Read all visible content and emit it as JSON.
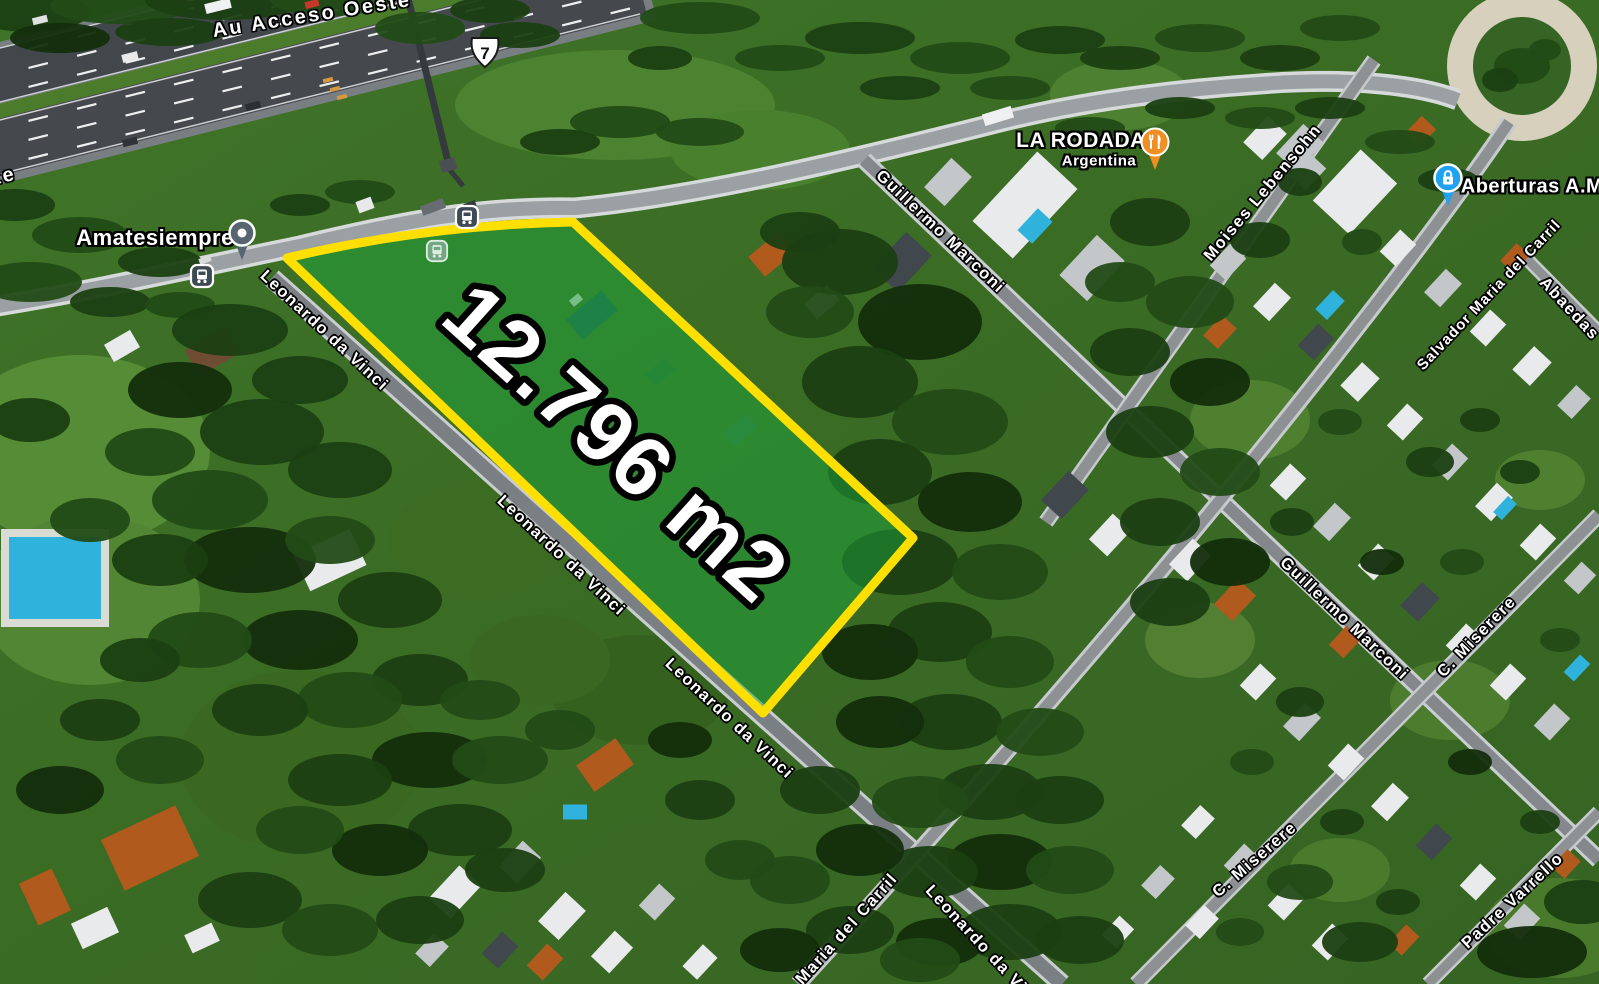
{
  "map_type": "satellite",
  "parcel": {
    "area_label": "12.796 m2",
    "outline_color": "#ffdf00",
    "fill_color": "rgba(30,165,60,0.5)"
  },
  "route_shield": {
    "number": "7"
  },
  "street_labels": [
    {
      "label": "Au Acceso Oeste"
    },
    {
      "label": "Au Acceso Oeste"
    },
    {
      "label": "Leonardo da Vinci"
    },
    {
      "label": "Leonardo da Vinci"
    },
    {
      "label": "Leonardo da Vinci"
    },
    {
      "label": "Leonardo da Vinci"
    },
    {
      "label": "Guillermo Marconi"
    },
    {
      "label": "Guillermo Marconi"
    },
    {
      "label": "Moises Lebensohn"
    },
    {
      "label": "Salvador Maria del Carril"
    },
    {
      "label": "Maria del Carril"
    },
    {
      "label": "C. Miserere"
    },
    {
      "label": "C. Miserere"
    },
    {
      "label": "Padre Varrello"
    },
    {
      "label": "Abaedas"
    }
  ],
  "places": [
    {
      "name": "Amatesiempre",
      "icon": "place-pin-icon",
      "pin_color": "#56656f"
    },
    {
      "name": "LA RODADA",
      "subtitle": "Argentina",
      "icon": "restaurant-icon",
      "pin_color": "#ef8e22"
    },
    {
      "name": "Aberturas A.M",
      "icon": "padlock-icon",
      "pin_color": "#1fa2f2"
    }
  ],
  "transit": {
    "bus_stop_icon": "bus-icon",
    "station_icon": "transit-icon"
  },
  "colors": {
    "parcel_outline": "#ffdf00",
    "bus_icon_bg": "#3d4a54",
    "restaurant_pin": "#ef8e22",
    "aberturas_pin": "#1fa2f2"
  }
}
